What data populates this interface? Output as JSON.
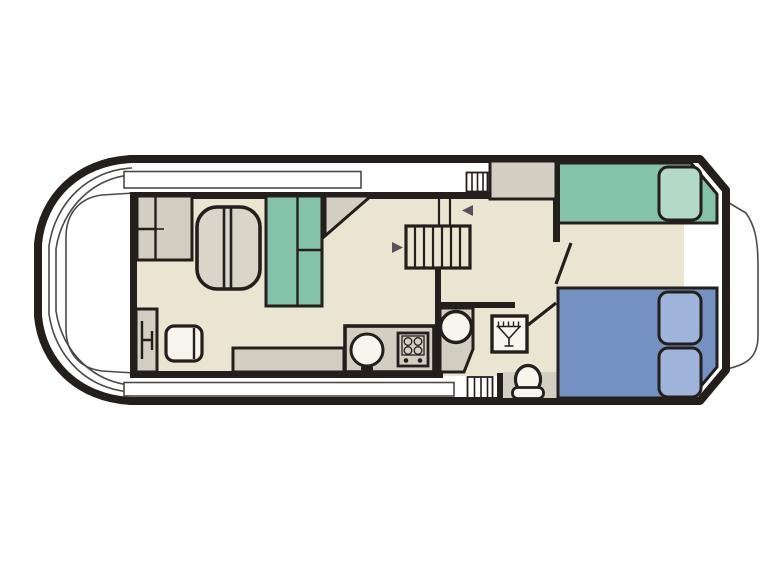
{
  "floorplan": {
    "kind": "boat-floorplan-top-view",
    "vessel": "canal-cruiser",
    "colors": {
      "ink": "#241f1d",
      "thin": "#4a4a48",
      "cream": "#eae5d1",
      "gray": "#d2cec1",
      "grayLight": "#d9d6c9",
      "offwhite": "#f8f6ec",
      "teal": "#85c2ac",
      "tealLight": "#b3d9c7",
      "blue": "#7391c1",
      "blueLight": "#9eb4d8",
      "arrow": "#5d4e5c"
    },
    "decks": [
      "bow-deck",
      "top-side-walkway",
      "bottom-side-walkway",
      "stern-deck"
    ],
    "rooms": [
      "saloon-dinette",
      "galley",
      "bathroom",
      "aft-cabin"
    ],
    "furniture": {
      "saloon": [
        "helm-console",
        "stool-seat",
        "storage-cabinet",
        "dinette-table",
        "wardrobe",
        "corner-locker",
        "bench-seat"
      ],
      "galley": [
        "worktop",
        "sink",
        "hob"
      ],
      "bathroom": [
        "washbasin-unit",
        "washbasin",
        "shower-tray",
        "toilet"
      ],
      "aft_cabin": [
        "single-berth",
        "double-berth",
        "pillow-count-3"
      ]
    },
    "stairs": {
      "location": "midships-companionway",
      "tread_count": 7,
      "direction_arrow_count": 2
    },
    "boarding_steps": [
      "top-gunwale-steps",
      "bottom-gunwale-steps"
    ],
    "doors": [
      "bathroom-door",
      "aft-cabin-door"
    ]
  }
}
